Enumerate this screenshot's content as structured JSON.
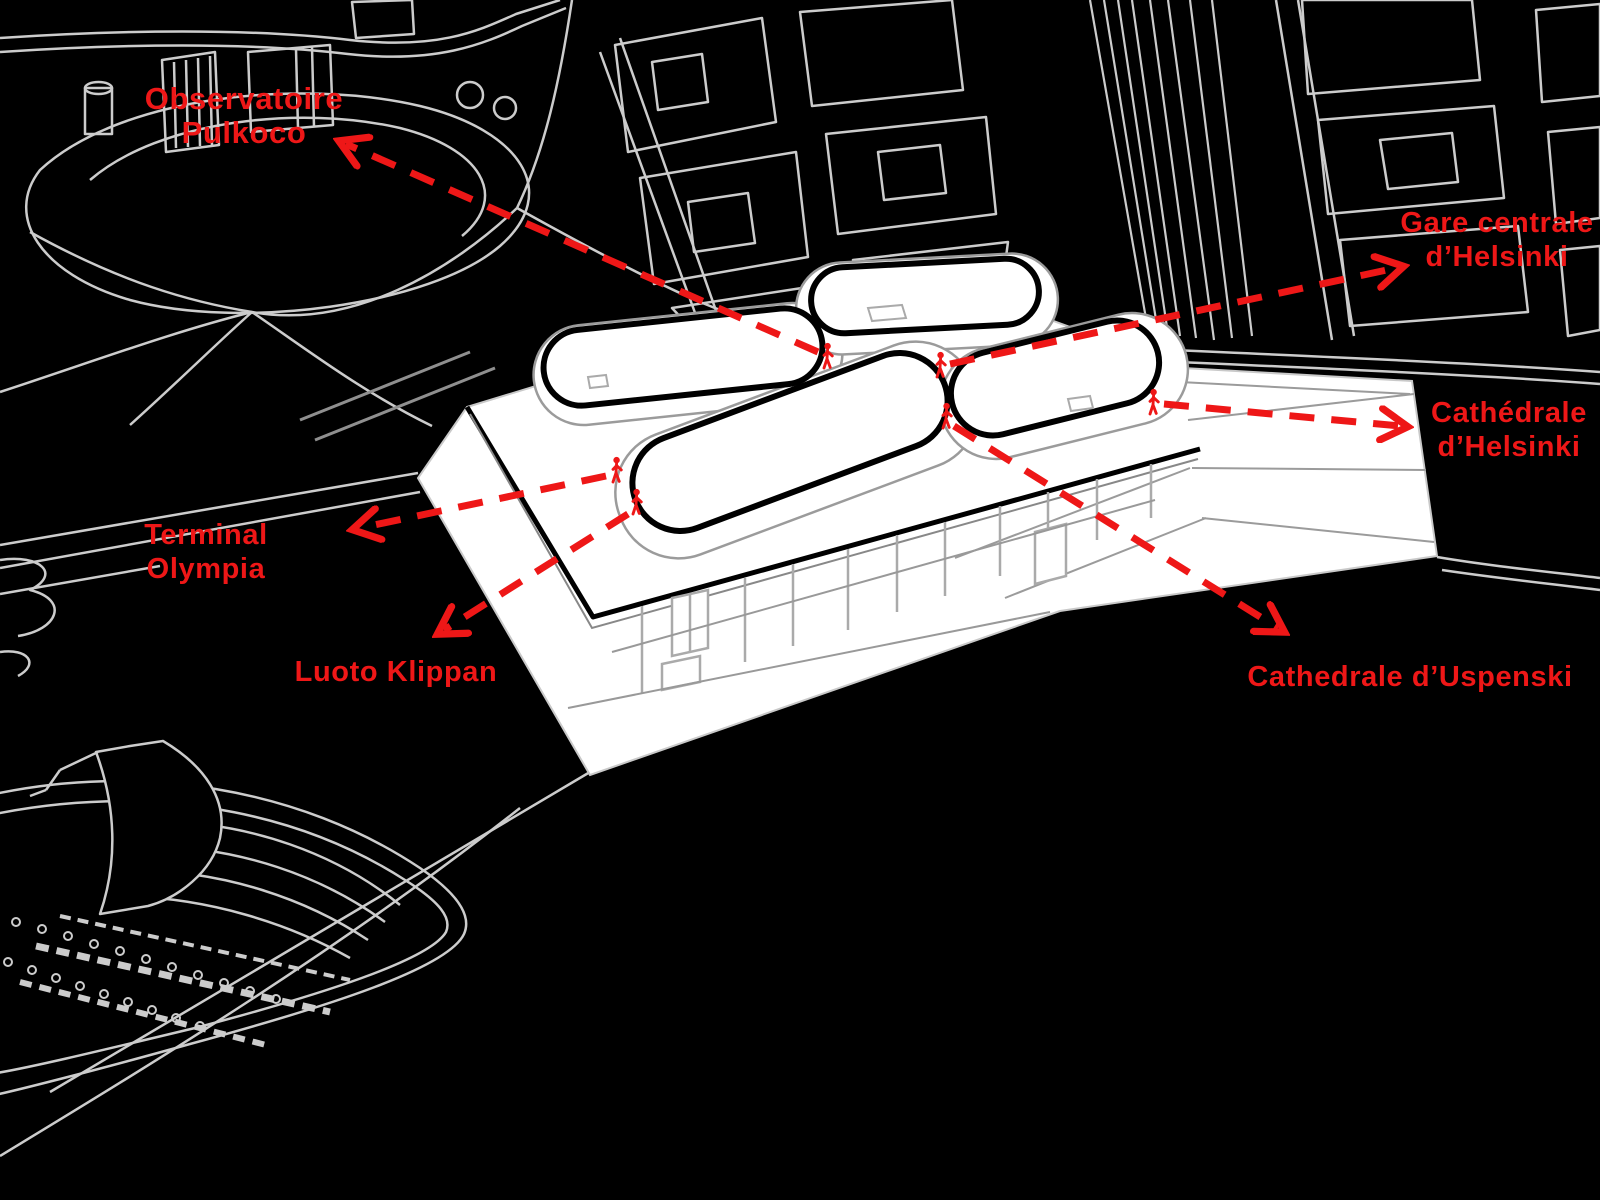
{
  "diagram": {
    "kind": "architectural-site-annotation-diagram",
    "colors": {
      "background": "#000000",
      "city_line_gray": "#cccccc",
      "contour_gray": "#9b9b9b",
      "structure_gray": "#aaaaaa",
      "building_white": "#ffffff",
      "outline_black": "#000000",
      "annotation_red": "#ee1717"
    },
    "icons": {
      "person_marker": "person-icon",
      "arrow_style": "red dashed arrow with open chevron head"
    }
  },
  "annotations": [
    {
      "id": "observatoire-pulkoco",
      "label": "Observatoire Pulkoco"
    },
    {
      "id": "gare-centrale",
      "label": "Gare centrale\nd’Helsinki"
    },
    {
      "id": "cathedrale-helsinki",
      "label": "Cathédrale\nd’Helsinki"
    },
    {
      "id": "terminal-olympia",
      "label": "Terminal Olympia"
    },
    {
      "id": "luoto-klippan",
      "label": "Luoto Klippan"
    },
    {
      "id": "cathedrale-uspenski",
      "label": "Cathedrale d’Uspenski"
    }
  ]
}
